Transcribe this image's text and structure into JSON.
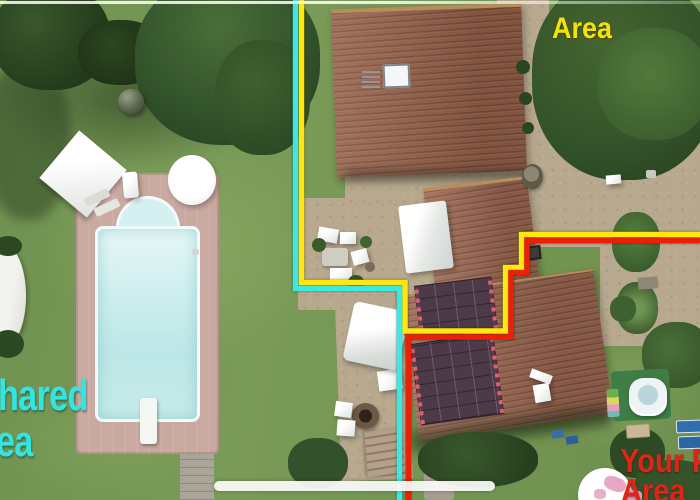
{
  "annotations": {
    "top_area_label": {
      "text": "Area",
      "color": "#f2e30b"
    },
    "shared_area_label": {
      "line1": "hared",
      "line2": "ea",
      "color": "#33e4e0"
    },
    "private_area_label": {
      "line1": "Your P",
      "line2": "Area",
      "color": "#de2517"
    }
  },
  "boundary_lines": {
    "cyan": "#3be8e2",
    "yellow": "#ffe70f",
    "red": "#ea2106"
  },
  "colors": {
    "line-cyan": "#3be8e2",
    "line-yellow": "#ffe70f",
    "line-red": "#ea2106",
    "label-yellow": "#f2e30b",
    "label-cyan": "#33e4e0",
    "label-red": "#de2517",
    "grass": "#6f9150",
    "gravel": "#b7a88e",
    "deck": "#c9a9a0",
    "pool": "#cdeeee",
    "roof": "#976149",
    "annex-roof": "#9c6750",
    "solar": "#4c3a49",
    "tub-pad": "#3f7d46",
    "lounger-blue": "#2f6fae",
    "home-bar": "#fbfbfb"
  }
}
